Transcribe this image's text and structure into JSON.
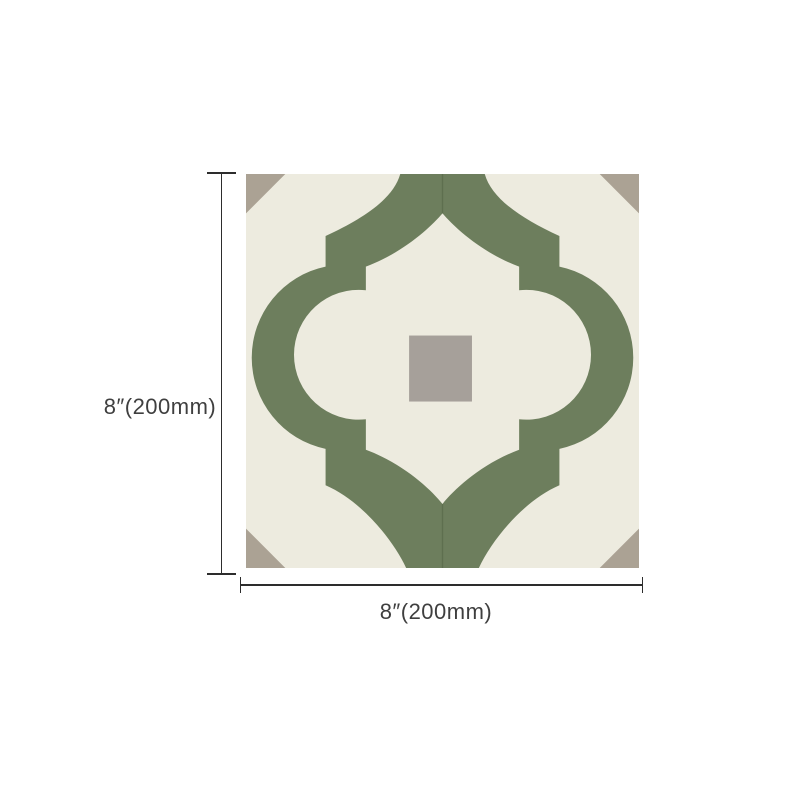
{
  "figure": {
    "height_dimension_label": "8″(200mm)",
    "width_dimension_label": "8″(200mm)"
  },
  "tile": {
    "colors": {
      "background": "#edebdf",
      "pattern_green": "#6d7e5d",
      "corner_triangle": "#aba294",
      "center_square": "#a6a09a",
      "seam": "#5e6f4f"
    }
  },
  "annotation": {
    "line_color": "#2d2d2d",
    "text_color": "#3f3f3f"
  }
}
